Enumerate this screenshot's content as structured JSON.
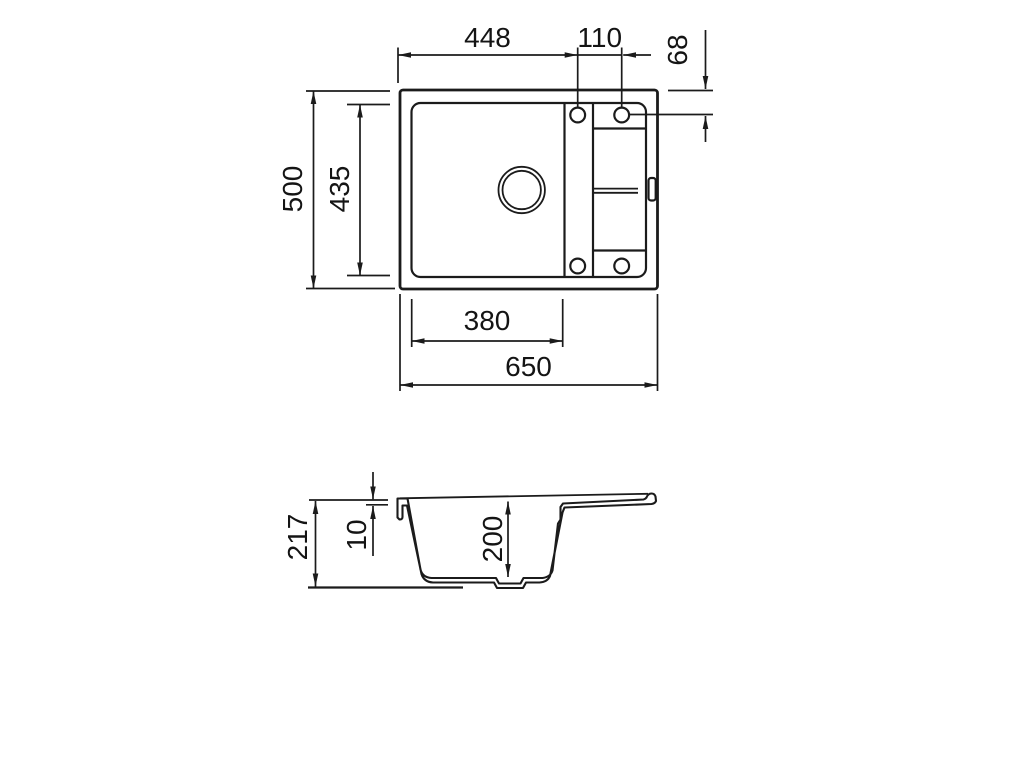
{
  "colors": {
    "line": "#1b1b1b",
    "background": "#ffffff"
  },
  "top_view": {
    "dims": {
      "holes_from_left": "448",
      "holes_spacing": "110",
      "holes_from_top": "68",
      "overall_front_to_back": "500",
      "inner_front_to_back": "435",
      "bowl_width": "380",
      "overall_width": "650"
    }
  },
  "section_view": {
    "dims": {
      "overall_height": "217",
      "rim_thickness": "10",
      "bowl_depth": "200"
    }
  }
}
